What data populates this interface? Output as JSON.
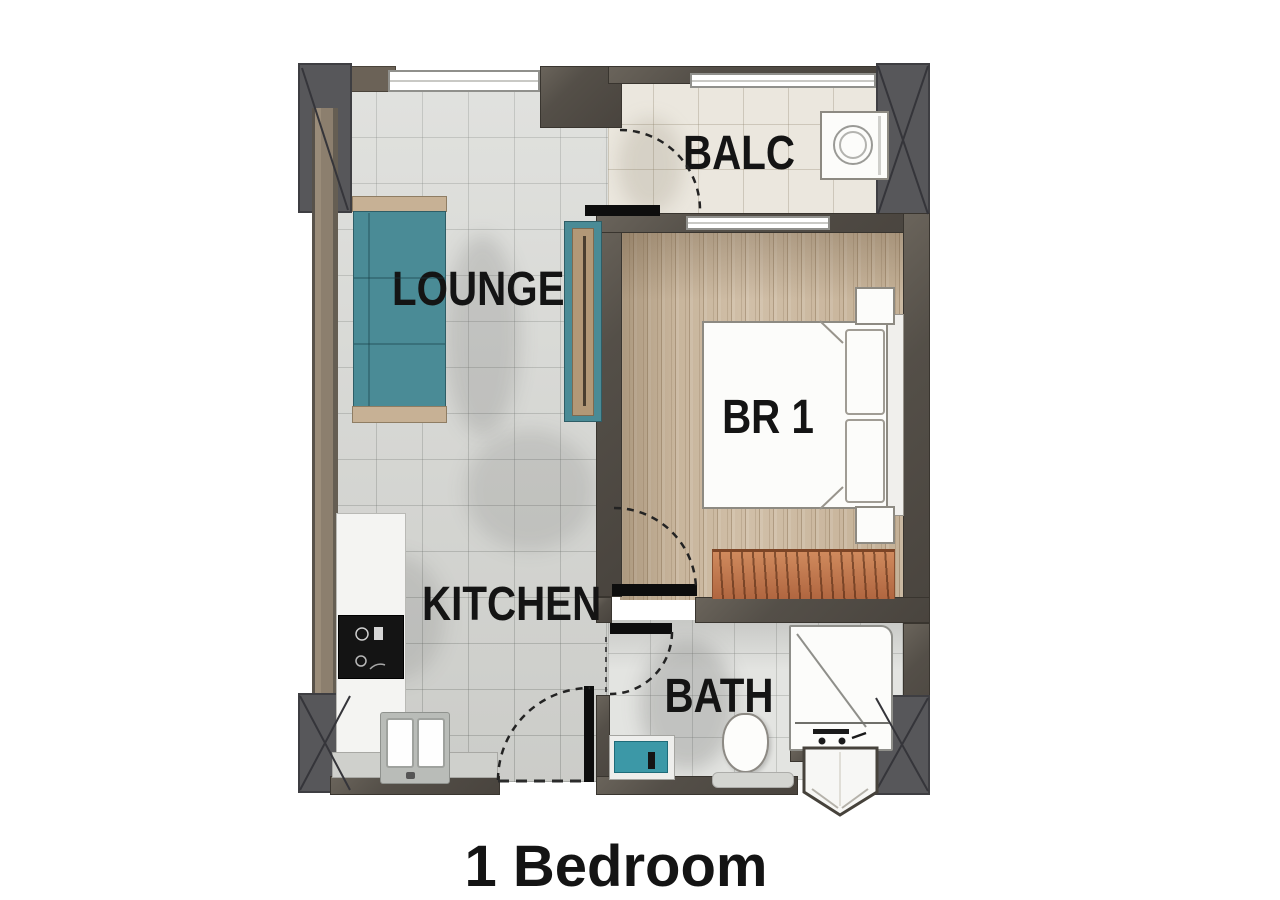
{
  "title": {
    "text": "1 Bedroom"
  },
  "rooms": {
    "lounge": {
      "label": "LOUNGE"
    },
    "balcony": {
      "label": "BALC"
    },
    "bedroom": {
      "label": "BR 1"
    },
    "kitchen": {
      "label": "KITCHEN"
    },
    "bath": {
      "label": "BATH"
    }
  },
  "fixtures": [
    "sofa",
    "tv-console",
    "washing-machine",
    "double-bed",
    "pillows",
    "nightstands",
    "wardrobe",
    "cooktop",
    "kitchen-sink",
    "vanity-basin",
    "toilet",
    "shower",
    "shower-door"
  ],
  "colors": {
    "wall-dark": "#544f48",
    "wall-brown": "#6b6257",
    "wall-tan": "#9a8c79",
    "column-gray": "#57575a",
    "floor-lounge": "#d8d9d5",
    "floor-balcony": "#ebe7de",
    "floor-bedroom": "#cdbaa1",
    "floor-bath": "#e3e4e1",
    "sofa-teal": "#4a8b96",
    "vanity-teal": "#3c98a7",
    "armrest-tan": "#c7b195",
    "wardrobe-orange": "#c97e52",
    "wood-trim": "#b29877",
    "ink": "#141414"
  }
}
